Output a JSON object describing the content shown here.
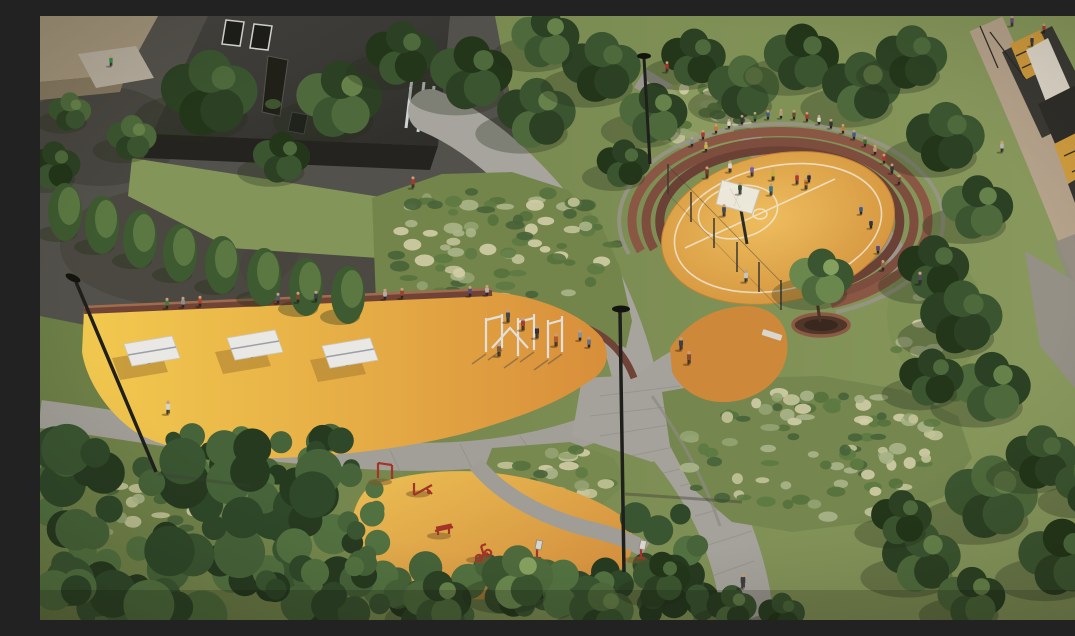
{
  "scene": {
    "description": "Aerial architectural rendering of a residential courtyard park: basketball court with curved amphitheater seating, table-tennis area, calisthenics bars, outdoor fitness zone with red machines, gray paver paths, lampposts, lawns, ornamental grass mounds, hedges and trees between two dark apartment buildings",
    "colors": {
      "lawn_light": "#8a9a5e",
      "lawn_dark": "#687b43",
      "asphalt": "#53514b",
      "path": "#a5a29b",
      "play_yellow": "#f2c94f",
      "play_orange": "#d88e3a",
      "court_light": "#eebd5e",
      "court_dark": "#cf8d38",
      "fitness_light": "#ecbf54",
      "fitness_dark": "#cf873a",
      "brick_wall": "#6f4336",
      "brick_seat_1": "#6b4035",
      "brick_seat_2": "#7d4d3d",
      "brick_seat_3": "#8b5745",
      "building_roof": "#3b3a35",
      "building_face": "#24231f",
      "roof_tan": "#a2947a",
      "window_amber": "#d9a23f",
      "sidewalk_tan": "#b5a28b",
      "equipment_red": "#a33527",
      "table_white": "#e9e8e4",
      "bars_white": "#e2e0da",
      "pole_black": "#1f1f1c",
      "tree_dark": "#2c4123",
      "tree_mid": "#4e6a3c",
      "tree_light": "#6a874e",
      "grass_pale": "#cfcaa3",
      "skin": "#c79e78"
    },
    "people": [
      [
        127,
        292,
        "#3f7a45",
        "t"
      ],
      [
        143,
        291,
        "#8a8f96",
        "t"
      ],
      [
        160,
        290,
        "#a8432f",
        "t"
      ],
      [
        238,
        287,
        "#4f5866",
        "t"
      ],
      [
        258,
        286,
        "#7a4a2f",
        "t"
      ],
      [
        276,
        285,
        "#3c4048",
        "t"
      ],
      [
        345,
        283,
        "#b3aea4",
        "t"
      ],
      [
        362,
        282,
        "#97452f",
        "t"
      ],
      [
        430,
        280,
        "#5b4a6e",
        "t"
      ],
      [
        447,
        279,
        "#b8b2a8",
        "t"
      ],
      [
        468,
        306,
        "#44474c",
        "s"
      ],
      [
        483,
        314,
        "#a3402e",
        "s"
      ],
      [
        497,
        322,
        "#2f3338",
        "s"
      ],
      [
        516,
        330,
        "#b05a2e",
        "s"
      ],
      [
        540,
        324,
        "#8a8f98",
        "t"
      ],
      [
        549,
        331,
        "#6b7280",
        "t"
      ],
      [
        459,
        340,
        "#7c5a3a",
        "s"
      ],
      [
        128,
        398,
        "#d8d4c8",
        "w"
      ],
      [
        71,
        50,
        "#2f9048",
        "w"
      ],
      [
        627,
        56,
        "#a8342c",
        "w"
      ],
      [
        962,
        136,
        "#b8b4ac",
        "w"
      ],
      [
        1048,
        330,
        "#2f7a3f",
        "w"
      ],
      [
        706,
        266,
        "#c9c5ba",
        "w"
      ],
      [
        641,
        334,
        "#3c4048",
        "w"
      ],
      [
        649,
        348,
        "#8a4a2f",
        "w"
      ],
      [
        373,
        172,
        "#a33a2c",
        "w"
      ],
      [
        703,
        572,
        "#3a3d44",
        "w"
      ],
      [
        880,
        268,
        "#4a4f57",
        "w"
      ],
      [
        667,
        162,
        "#7a3b2c",
        "s"
      ],
      [
        690,
        156,
        "#d9d5cc",
        "s"
      ],
      [
        712,
        160,
        "#7a5a9c",
        "s"
      ],
      [
        733,
        164,
        "#c2b23a",
        "s"
      ],
      [
        757,
        168,
        "#b03a2e",
        "s"
      ],
      [
        700,
        178,
        "#32502e",
        "s"
      ],
      [
        731,
        179,
        "#3a7a8c",
        "s"
      ],
      [
        766,
        173,
        "#c4762b",
        "s"
      ],
      [
        769,
        166,
        "#2f2f33",
        "t"
      ],
      [
        684,
        200,
        "#444a52",
        "s"
      ],
      [
        663,
        123,
        "#a8392c",
        "t"
      ],
      [
        676,
        117,
        "#c4762b",
        "t"
      ],
      [
        689,
        112,
        "#d9d5cc",
        "t"
      ],
      [
        702,
        108,
        "#33363b",
        "t"
      ],
      [
        715,
        105,
        "#3f6a3c",
        "t"
      ],
      [
        728,
        103,
        "#3f5a86",
        "t"
      ],
      [
        741,
        102,
        "#b39a78",
        "t"
      ],
      [
        754,
        103,
        "#6f4a33",
        "t"
      ],
      [
        767,
        105,
        "#a8392c",
        "t"
      ],
      [
        779,
        108,
        "#d9d5cc",
        "t"
      ],
      [
        791,
        112,
        "#33363b",
        "t"
      ],
      [
        803,
        117,
        "#c4762b",
        "t"
      ],
      [
        814,
        123,
        "#3f5a86",
        "t"
      ],
      [
        825,
        130,
        "#3f6a3c",
        "t"
      ],
      [
        835,
        138,
        "#b39a78",
        "t"
      ],
      [
        844,
        147,
        "#a8392c",
        "t"
      ],
      [
        852,
        157,
        "#33363b",
        "t"
      ],
      [
        859,
        168,
        "#6f4a33",
        "t"
      ],
      [
        821,
        198,
        "#3f5a86",
        "t"
      ],
      [
        831,
        212,
        "#33363b",
        "t"
      ],
      [
        838,
        237,
        "#5a4a6e",
        "t"
      ],
      [
        843,
        254,
        "#8a6a4a",
        "t"
      ],
      [
        666,
        135,
        "#c9b34a",
        "t"
      ],
      [
        652,
        130,
        "#7a8c96",
        "t"
      ],
      [
        972,
        10,
        "#6a4a8c",
        "s"
      ],
      [
        992,
        30,
        "#3a3a3f",
        "s"
      ],
      [
        1004,
        16,
        "#a8392c",
        "t"
      ]
    ],
    "trees": [
      [
        170,
        78,
        54,
        0
      ],
      [
        300,
        84,
        48,
        1
      ],
      [
        362,
        38,
        40,
        0
      ],
      [
        92,
        122,
        28,
        1
      ],
      [
        242,
        142,
        32,
        0
      ],
      [
        14,
        150,
        30,
        0
      ],
      [
        30,
        96,
        24,
        1
      ],
      [
        432,
        58,
        46,
        0
      ],
      [
        497,
        98,
        44,
        1
      ],
      [
        562,
        52,
        44,
        0
      ],
      [
        614,
        98,
        38,
        1
      ],
      [
        654,
        42,
        36,
        0
      ],
      [
        704,
        72,
        40,
        1
      ],
      [
        762,
        42,
        42,
        0
      ],
      [
        822,
        72,
        44,
        1
      ],
      [
        872,
        42,
        40,
        0
      ],
      [
        506,
        22,
        38,
        1
      ],
      [
        584,
        148,
        30,
        0
      ],
      [
        906,
        122,
        44,
        0
      ],
      [
        938,
        192,
        40,
        1
      ],
      [
        894,
        252,
        40,
        0
      ],
      [
        922,
        302,
        46,
        0
      ],
      [
        952,
        372,
        44,
        1
      ],
      [
        892,
        362,
        36,
        0
      ],
      [
        952,
        482,
        52,
        1
      ],
      [
        1022,
        542,
        48,
        0
      ],
      [
        882,
        542,
        44,
        1
      ],
      [
        1002,
        442,
        40,
        0
      ],
      [
        932,
        582,
        38,
        1
      ],
      [
        862,
        502,
        34,
        0
      ],
      [
        1048,
        470,
        36,
        1
      ],
      [
        398,
        586,
        38,
        1
      ],
      [
        478,
        562,
        40,
        2
      ],
      [
        562,
        596,
        36,
        1
      ],
      [
        622,
        562,
        32,
        0
      ],
      [
        692,
        592,
        28,
        1
      ],
      [
        742,
        598,
        26,
        0
      ],
      [
        782,
        262,
        36,
        2
      ]
    ],
    "columnar_trees": [
      [
        25,
        196
      ],
      [
        62,
        209
      ],
      [
        100,
        223
      ],
      [
        140,
        237
      ],
      [
        182,
        249
      ],
      [
        224,
        261
      ],
      [
        266,
        271
      ],
      [
        308,
        279
      ]
    ],
    "tables": [
      [
        110,
        336
      ],
      [
        213,
        330
      ],
      [
        308,
        338
      ]
    ],
    "equipment": [
      [
        345,
        462,
        "frame"
      ],
      [
        383,
        474,
        "beam"
      ],
      [
        404,
        516,
        "bench"
      ],
      [
        443,
        540,
        "bike"
      ],
      [
        497,
        540,
        "board"
      ],
      [
        601,
        540,
        "board"
      ]
    ]
  }
}
